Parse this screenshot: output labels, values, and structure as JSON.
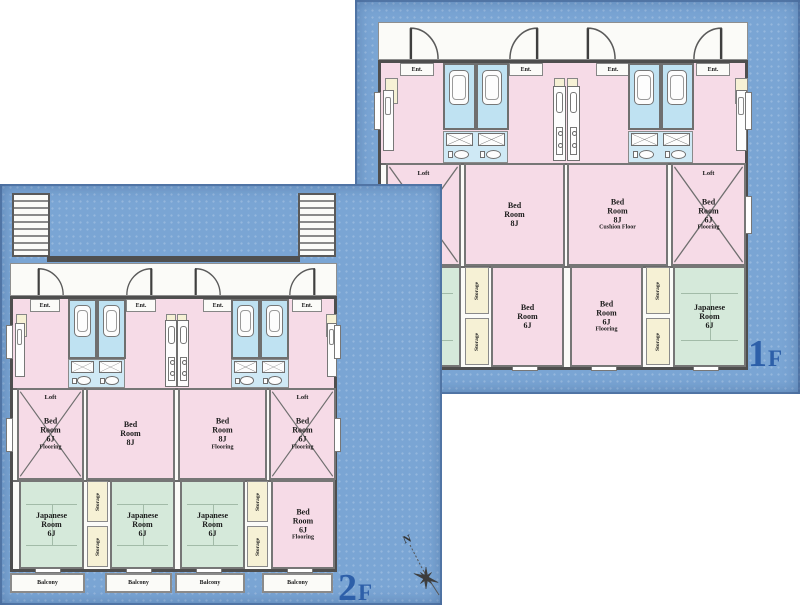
{
  "title": "Apartment floor plans 1F / 2F",
  "colors": {
    "page_bg": "#ffffff",
    "panel_blue": "#7aa5d4",
    "panel_edge_blue": "#54779f",
    "floor_white": "#fbfbf8",
    "wall_gray": "#4e4e4e",
    "room_pink": "#f6dbe7",
    "room_green": "#d5e9da",
    "bath_blue": "#bfe2f2",
    "wash_blue": "#cfe9f5",
    "storage_cream": "#f6f1d5",
    "floor_label_blue": "#2d5fa9",
    "compass_dark": "#3d3d3d"
  },
  "shared_labels": {
    "ent": "Ent.",
    "loft": "Loft",
    "storage": "Storage",
    "balcony": "Balcony"
  },
  "compass": {
    "north_label": "N"
  },
  "floors": [
    {
      "id": "1F",
      "floor_label_num": "1",
      "floor_label_suffix": "F",
      "has_stairs": false,
      "has_balconies": false,
      "ent_count": 4,
      "mid_rooms": [
        {
          "kind": "loft-bed",
          "lines": [
            "Bed",
            "Room",
            "6J",
            "Flooring"
          ]
        },
        {
          "kind": "bed",
          "lines": [
            "Bed",
            "Room",
            "8J"
          ]
        },
        {
          "kind": "bed",
          "lines": [
            "Bed",
            "Room",
            "8J",
            "Cushion Floor"
          ]
        },
        {
          "kind": "loft-bed",
          "lines": [
            "Bed",
            "Room",
            "6J",
            "Flooring"
          ]
        }
      ],
      "bottom_rooms": [
        {
          "kind": "japanese",
          "lines": [
            "Japanese",
            "Room",
            "6J"
          ]
        },
        {
          "kind": "bed",
          "lines": [
            "Bed",
            "Room",
            "6J"
          ]
        },
        {
          "kind": "bed",
          "lines": [
            "Bed",
            "Room",
            "6J",
            "Flooring"
          ]
        },
        {
          "kind": "japanese",
          "lines": [
            "Japanese",
            "Room",
            "6J"
          ]
        }
      ],
      "storage_columns": 2,
      "storage_boxes_per_column": 2
    },
    {
      "id": "2F",
      "floor_label_num": "2",
      "floor_label_suffix": "F",
      "has_stairs": true,
      "has_balconies": true,
      "ent_count": 4,
      "balcony_count": 4,
      "stair_count": 2,
      "mid_rooms": [
        {
          "kind": "loft-bed",
          "lines": [
            "Bed",
            "Room",
            "6J",
            "Flooring"
          ]
        },
        {
          "kind": "bed",
          "lines": [
            "Bed",
            "Room",
            "8J"
          ]
        },
        {
          "kind": "bed",
          "lines": [
            "Bed",
            "Room",
            "8J",
            "Flooring"
          ]
        },
        {
          "kind": "loft-bed",
          "lines": [
            "Bed",
            "Room",
            "6J",
            "Flooring"
          ]
        }
      ],
      "bottom_rooms": [
        {
          "kind": "japanese",
          "lines": [
            "Japanese",
            "Room",
            "6J"
          ]
        },
        {
          "kind": "japanese",
          "lines": [
            "Japanese",
            "Room",
            "6J"
          ]
        },
        {
          "kind": "japanese",
          "lines": [
            "Japanese",
            "Room",
            "6J"
          ]
        },
        {
          "kind": "bed",
          "lines": [
            "Bed",
            "Room",
            "6J",
            "Flooring"
          ]
        }
      ],
      "storage_columns": 2,
      "storage_boxes_per_column": 2
    }
  ]
}
